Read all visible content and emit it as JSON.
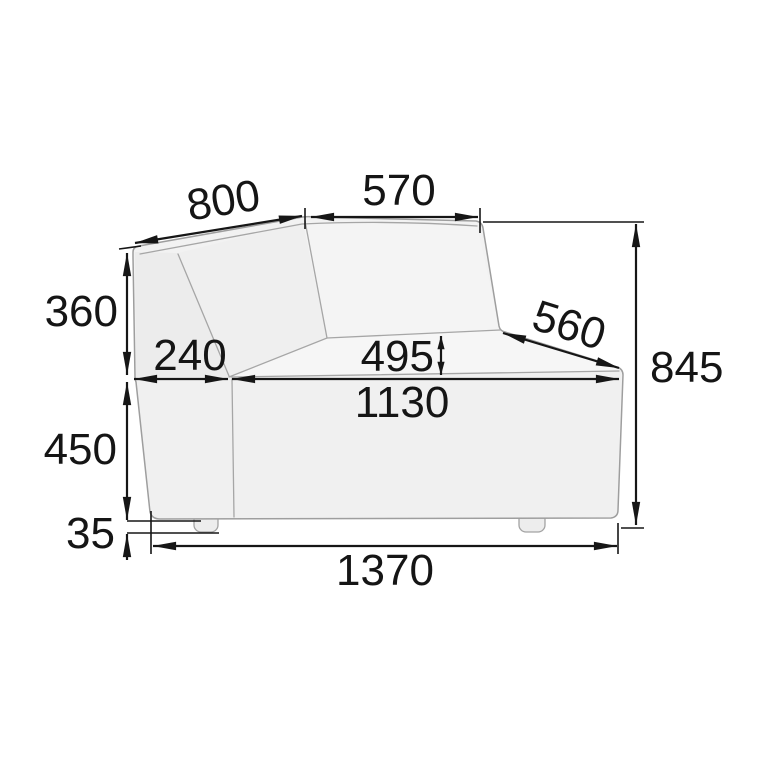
{
  "diagram": {
    "type": "furniture-dimension-drawing",
    "subject": "modular corner sofa section, front view with dimension lines",
    "unit": "mm",
    "colors": {
      "background": "#ffffff",
      "sofa_fill": "#f2f2f2",
      "sofa_outline": "#9e9e9e",
      "dimension_lines": "#161616"
    },
    "dimensions": {
      "back_left_width": {
        "value": "800",
        "orientation": "angled-top-left"
      },
      "back_right_width": {
        "value": "570",
        "orientation": "horizontal-top"
      },
      "back_height": {
        "value": "360",
        "orientation": "vertical-left"
      },
      "left_seat_depth": {
        "value": "240",
        "orientation": "horizontal-seat-left"
      },
      "seat_depth_mark": {
        "value": "495",
        "orientation": "vertical-small-center"
      },
      "open_end_depth": {
        "value": "560",
        "orientation": "angled-right"
      },
      "total_height": {
        "value": "845",
        "orientation": "vertical-right"
      },
      "seat_width": {
        "value": "1130",
        "orientation": "horizontal-seat"
      },
      "base_height": {
        "value": "450",
        "orientation": "vertical-lower-left"
      },
      "leg_height": {
        "value": "35",
        "orientation": "vertical-bottom-left"
      },
      "total_width": {
        "value": "1370",
        "orientation": "horizontal-bottom"
      }
    }
  }
}
